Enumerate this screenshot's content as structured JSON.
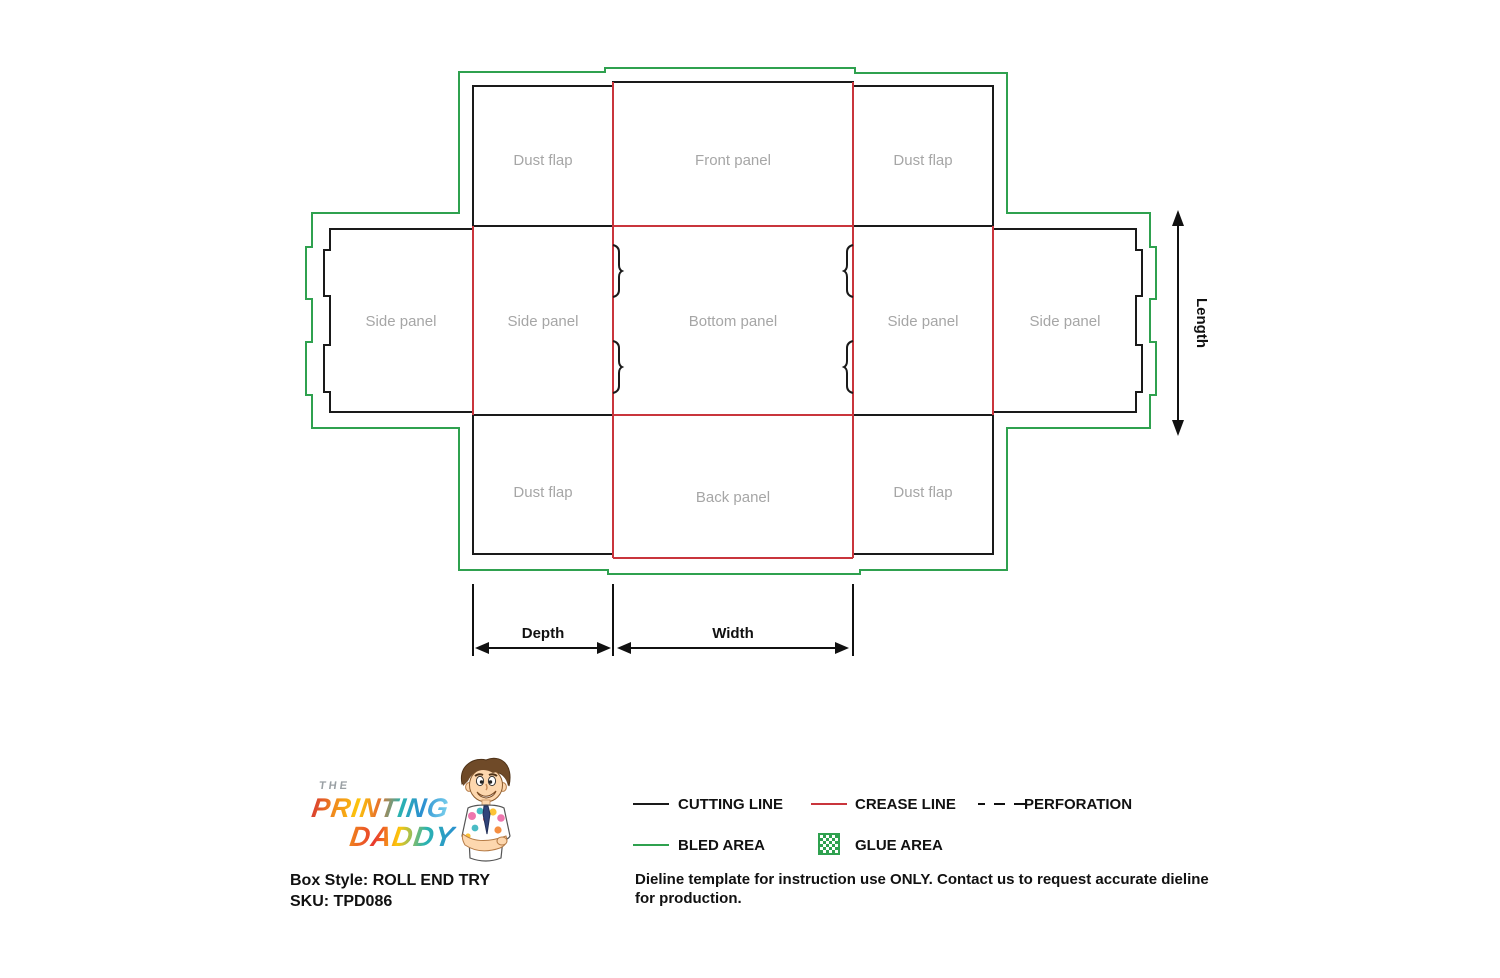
{
  "colors": {
    "cutting_line": "#1a1a1a",
    "crease_line": "#c9353c",
    "bleed_area": "#2fa14f",
    "panel_label": "#a6a6a6",
    "text": "#111111",
    "background": "#ffffff"
  },
  "dieline": {
    "panels": [
      {
        "id": "dust-flap-top-left",
        "label": "Dust flap"
      },
      {
        "id": "front-panel",
        "label": "Front panel"
      },
      {
        "id": "dust-flap-top-right",
        "label": "Dust flap"
      },
      {
        "id": "side-panel-outer-left",
        "label": "Side panel"
      },
      {
        "id": "side-panel-inner-left",
        "label": "Side panel"
      },
      {
        "id": "bottom-panel",
        "label": "Bottom panel"
      },
      {
        "id": "side-panel-inner-right",
        "label": "Side panel"
      },
      {
        "id": "side-panel-outer-right",
        "label": "Side panel"
      },
      {
        "id": "dust-flap-bottom-left",
        "label": "Dust flap"
      },
      {
        "id": "back-panel",
        "label": "Back panel"
      },
      {
        "id": "dust-flap-bottom-right",
        "label": "Dust flap"
      }
    ],
    "dimensions": {
      "length": "Length",
      "depth": "Depth",
      "width": "Width"
    }
  },
  "legend": {
    "cutting_line": "CUTTING LINE",
    "crease_line": "CREASE LINE",
    "perforation": "PERFORATION",
    "bled_area": "BLED AREA",
    "glue_area": "GLUE AREA"
  },
  "footer": {
    "logo": {
      "the": "THE",
      "printing": "PRINTING",
      "daddy": "DADDY"
    },
    "box_style": "Box Style: ROLL END TRY",
    "sku": "SKU: TPD086",
    "disclaimer": "Dieline template for instruction use ONLY. Contact us to request accurate dieline for production."
  }
}
